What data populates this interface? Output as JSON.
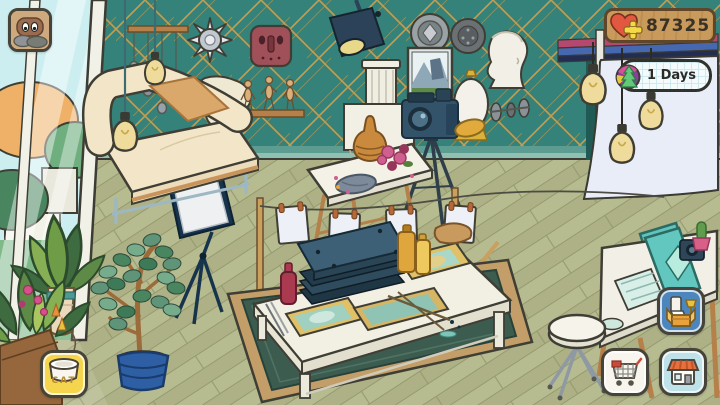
{
  "hud": {
    "menu_button": {
      "icon": "hamster-face-icon"
    },
    "hearts_counter": {
      "value": "87325",
      "heart_icon": "heart-icon",
      "plus_icon": "plus-icon"
    },
    "days_badge": {
      "label": "1 Days",
      "icon": "rainbow-tree-icon"
    },
    "cat_food_button": {
      "label": "CAT",
      "icon": "cat-bowl-icon"
    },
    "inventory_button": {
      "icon": "furniture-box-icon"
    },
    "cart_button": {
      "icon": "shopping-cart-icon"
    },
    "shop_button": {
      "icon": "storefront-icon"
    }
  },
  "colors": {
    "wall_teal": "#35827a",
    "wall_gold_pattern": "#c49d4f",
    "floor_olive": "#b7bb90",
    "backdrop_white": "#e9edf8",
    "heart_red": "#e2573f",
    "plus_yellow": "#f5d848",
    "sign_wood": "#c89a5c",
    "button_yellow": "#f5d54e",
    "button_blue": "#4d86bd",
    "button_light_blue": "#bfe2e8",
    "rug_green": "#3d5c50",
    "monitor_teal": "#5fc5bc"
  },
  "scene": {
    "objects": [
      "garden-window",
      "cream-sofa",
      "hanging-edison-bulbs",
      "pebble-mobile",
      "sun-mask",
      "squiggle-sculpture",
      "red-tribal-mask",
      "mannequin-figurines",
      "stage-spotlight",
      "wall-plates",
      "landscape-painting",
      "roman-column",
      "plaster-bust",
      "white-urn",
      "wall-discs",
      "camera-on-tripod",
      "yellow-beret",
      "still-life-table",
      "amber-vase",
      "clothesline-with-prints",
      "printmaking-table",
      "screen-frames",
      "press-stack",
      "ink-bottles",
      "area-rug",
      "photo-backdrop",
      "desk-with-monitor",
      "rolling-stool",
      "softbox-light",
      "potted-tree",
      "leafy-plant",
      "flower-planter",
      "cat-food-bowl"
    ]
  }
}
